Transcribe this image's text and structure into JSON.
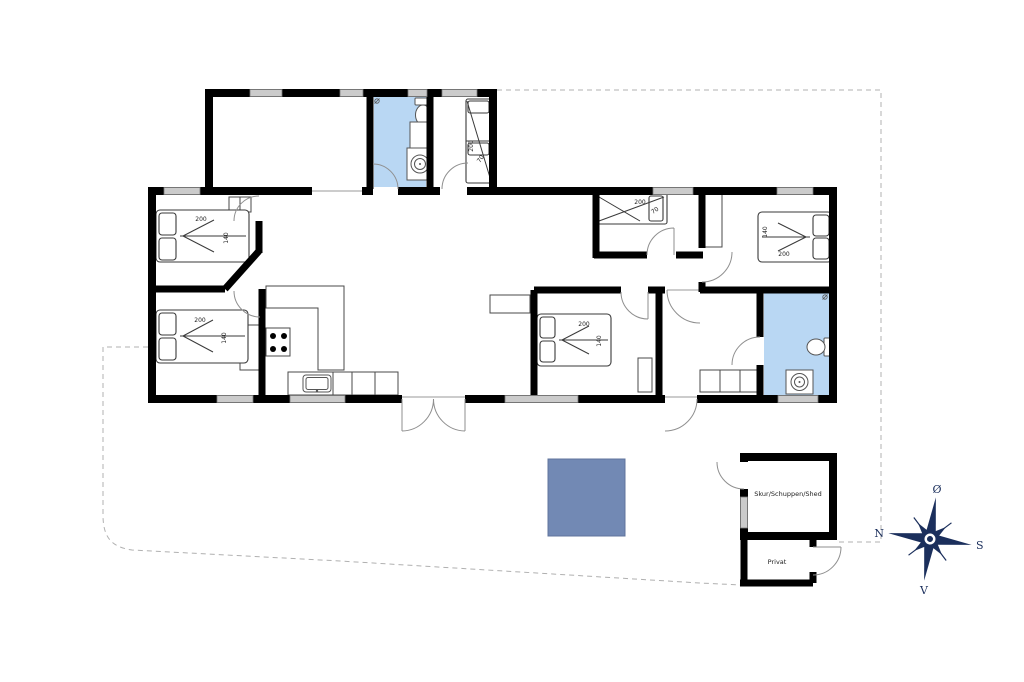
{
  "colors": {
    "wall": "#000000",
    "bathroom_fill": "#b9d7f3",
    "terrace_fill": "#7289b4",
    "window_fill": "#cbcbcb",
    "compass": "#1b2f5c",
    "boundary_dash": "#b0b0b0"
  },
  "beds": [
    {
      "room": "bedroom-top-left",
      "length": "200",
      "width": "140"
    },
    {
      "room": "bedroom-bottom-left",
      "length": "200",
      "width": "140"
    },
    {
      "room": "bedroom-middle",
      "length": "200",
      "width": "140"
    },
    {
      "room": "bedroom-right",
      "length": "200",
      "width": "140"
    },
    {
      "room": "bunkroom-wing",
      "length": "200",
      "width": "70"
    },
    {
      "room": "bunkroom-north",
      "length": "200",
      "width": "70"
    }
  ],
  "outbuilding": {
    "shed_label": "Skur/Schuppen/Shed",
    "privat_label": "Privat"
  },
  "compass": {
    "north": "N",
    "south": "S",
    "east": "Ø",
    "west": "V"
  }
}
